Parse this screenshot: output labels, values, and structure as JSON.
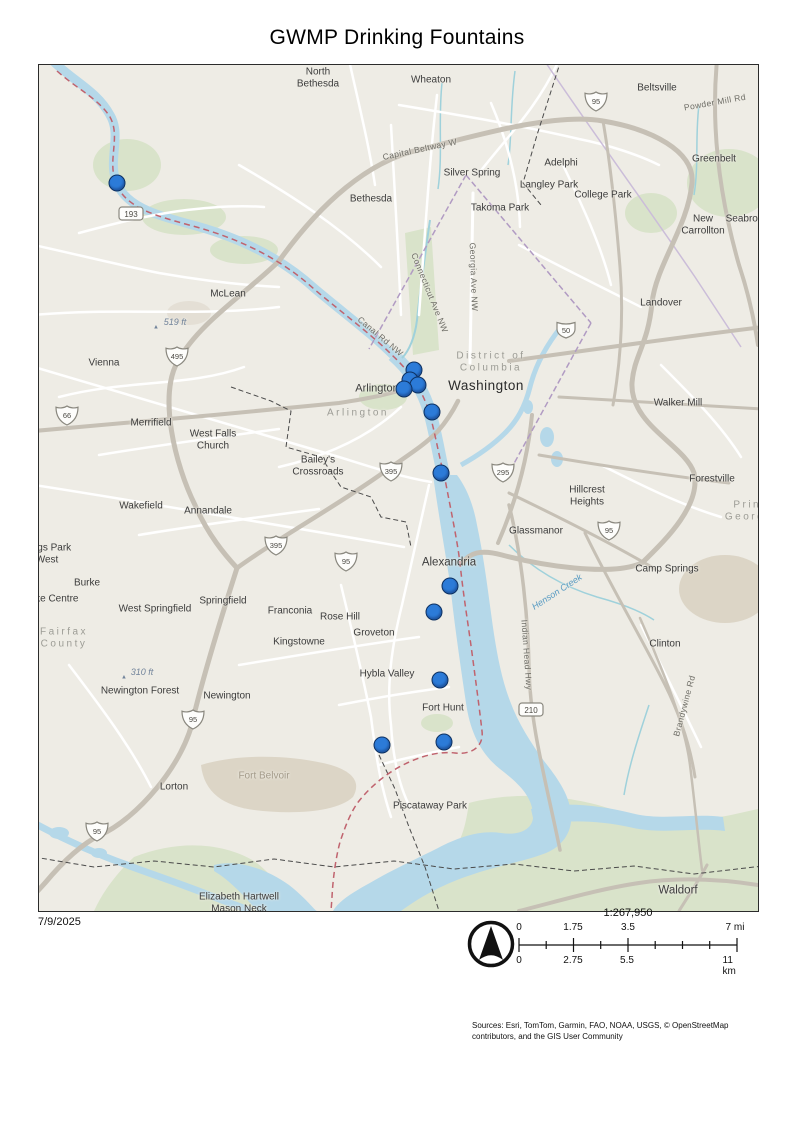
{
  "title": "GWMP Drinking Fountains",
  "footer": {
    "date": "7/9/2025",
    "scale_ratio": "1:267,950",
    "scale_mi": [
      "0",
      "1.75",
      "3.5",
      "7 mi"
    ],
    "scale_km": [
      "0",
      "2.75",
      "5.5",
      "11 km"
    ],
    "sources": "Sources: Esri, TomTom, Garmin, FAO, NOAA, USGS, © OpenStreetMap contributors, and the GIS User Community"
  },
  "colors": {
    "marker_fill": "#2c7bd8",
    "marker_stroke": "#0d3060",
    "land": "#eeece5",
    "water": "#b5d8e9",
    "park_green": "#d9e3ca",
    "trail_red": "#c0636e",
    "dc_boundary": "#b19bc3"
  },
  "map": {
    "labels": [
      {
        "t": "North Bethesda",
        "x": 279,
        "y": 13,
        "w": 64
      },
      {
        "t": "Wheaton",
        "x": 392,
        "y": 15
      },
      {
        "t": "Beltsville",
        "x": 618,
        "y": 23
      },
      {
        "t": "Powder Mill Rd",
        "x": 676,
        "y": 38,
        "c": "road",
        "r": -10
      },
      {
        "t": "Greenbelt",
        "x": 675,
        "y": 94
      },
      {
        "t": "Silver Spring",
        "x": 433,
        "y": 108
      },
      {
        "t": "Adelphi",
        "x": 522,
        "y": 98
      },
      {
        "t": "Langley Park",
        "x": 510,
        "y": 120
      },
      {
        "t": "College Park",
        "x": 564,
        "y": 130
      },
      {
        "t": "Takoma Park",
        "x": 461,
        "y": 143
      },
      {
        "t": "New Carrollton",
        "x": 664,
        "y": 160,
        "w": 62
      },
      {
        "t": "Seabrook",
        "x": 708,
        "y": 154
      },
      {
        "t": "Bethesda",
        "x": 332,
        "y": 134
      },
      {
        "t": "Capital Beltway W",
        "x": 381,
        "y": 85,
        "c": "road",
        "r": -12
      },
      {
        "t": "Connecticut Ave NW",
        "x": 390,
        "y": 228,
        "c": "road",
        "r": 68
      },
      {
        "t": "Georgia Ave NW",
        "x": 434,
        "y": 212,
        "c": "road",
        "r": 88
      },
      {
        "t": "Canal Rd NW",
        "x": 341,
        "y": 272,
        "c": "road",
        "r": 40
      },
      {
        "t": "McLean",
        "x": 189,
        "y": 229
      },
      {
        "t": "519 ft",
        "x": 136,
        "y": 257,
        "c": "elev"
      },
      {
        "t": "▲",
        "x": 117,
        "y": 263,
        "c": "elevmark"
      },
      {
        "t": "Vienna",
        "x": 65,
        "y": 298
      },
      {
        "t": "District of Columbia",
        "x": 452,
        "y": 297,
        "c": "gray",
        "w": 120
      },
      {
        "t": "Washington",
        "x": 447,
        "y": 321,
        "c": "place-lg"
      },
      {
        "t": "Arlington",
        "x": 338,
        "y": 324,
        "c": "place-md2"
      },
      {
        "t": "Arlington",
        "x": 319,
        "y": 348,
        "c": "gray"
      },
      {
        "t": "Merrifield",
        "x": 112,
        "y": 358
      },
      {
        "t": "West Falls Church",
        "x": 174,
        "y": 375,
        "w": 72
      },
      {
        "t": "Bailey's Crossroads",
        "x": 279,
        "y": 401,
        "w": 84
      },
      {
        "t": "Landover",
        "x": 622,
        "y": 238
      },
      {
        "t": "Walker Mill",
        "x": 639,
        "y": 338
      },
      {
        "t": "Forestville",
        "x": 673,
        "y": 414
      },
      {
        "t": "Hillcrest Heights",
        "x": 548,
        "y": 431,
        "w": 62
      },
      {
        "t": "Glassmanor",
        "x": 497,
        "y": 466
      },
      {
        "t": "Wakefield",
        "x": 102,
        "y": 441
      },
      {
        "t": "Annandale",
        "x": 169,
        "y": 446
      },
      {
        "t": "Kings Park West",
        "x": 8,
        "y": 489,
        "w": 66
      },
      {
        "t": "Burke",
        "x": 48,
        "y": 518
      },
      {
        "t": "Burke Centre",
        "x": 10,
        "y": 534
      },
      {
        "t": "Fairfax County",
        "x": 25,
        "y": 573,
        "c": "gray",
        "w": 70
      },
      {
        "t": "West Springfield",
        "x": 116,
        "y": 544,
        "w": 78
      },
      {
        "t": "Springfield",
        "x": 184,
        "y": 536
      },
      {
        "t": "Franconia",
        "x": 251,
        "y": 546
      },
      {
        "t": "Rose Hill",
        "x": 301,
        "y": 552
      },
      {
        "t": "Kingstowne",
        "x": 260,
        "y": 577
      },
      {
        "t": "Groveton",
        "x": 335,
        "y": 568
      },
      {
        "t": "Alexandria",
        "x": 410,
        "y": 498,
        "c": "place-md"
      },
      {
        "t": "Henson Creek",
        "x": 518,
        "y": 527,
        "c": "water",
        "r": -33
      },
      {
        "t": "Camp Springs",
        "x": 628,
        "y": 504
      },
      {
        "t": "Clinton",
        "x": 626,
        "y": 579
      },
      {
        "t": "Indian Head Hwy",
        "x": 487,
        "y": 590,
        "c": "road",
        "r": 86
      },
      {
        "t": "Brandywine Rd",
        "x": 646,
        "y": 641,
        "c": "road",
        "r": -75
      },
      {
        "t": "Hybla Valley",
        "x": 348,
        "y": 609
      },
      {
        "t": "Fort Hunt",
        "x": 404,
        "y": 643
      },
      {
        "t": "310 ft",
        "x": 103,
        "y": 607,
        "c": "elev"
      },
      {
        "t": "▲",
        "x": 85,
        "y": 613,
        "c": "elevmark"
      },
      {
        "t": "Newington Forest",
        "x": 101,
        "y": 626,
        "w": 80
      },
      {
        "t": "Newington",
        "x": 188,
        "y": 631
      },
      {
        "t": "Lorton",
        "x": 135,
        "y": 722
      },
      {
        "t": "Fort Belvoir",
        "x": 225,
        "y": 711,
        "c": "military"
      },
      {
        "t": "Piscataway Park",
        "x": 391,
        "y": 741
      },
      {
        "t": "Elizabeth Hartwell Mason Neck",
        "x": 200,
        "y": 838,
        "w": 92
      },
      {
        "t": "Waldorf",
        "x": 639,
        "y": 826,
        "c": "place-md"
      },
      {
        "t": "Prince George's",
        "x": 716,
        "y": 446,
        "c": "gray",
        "w": 66
      }
    ],
    "shields": [
      {
        "type": "interstate",
        "num": "95",
        "x": 557,
        "y": 39
      },
      {
        "type": "interstate",
        "num": "495",
        "x": 138,
        "y": 294
      },
      {
        "type": "interstate",
        "num": "66",
        "x": 28,
        "y": 353
      },
      {
        "type": "interstate",
        "num": "395",
        "x": 352,
        "y": 409
      },
      {
        "type": "interstate",
        "num": "395",
        "x": 237,
        "y": 483
      },
      {
        "type": "interstate",
        "num": "95",
        "x": 307,
        "y": 499
      },
      {
        "type": "interstate",
        "num": "295",
        "x": 464,
        "y": 410
      },
      {
        "type": "interstate",
        "num": "95",
        "x": 570,
        "y": 468
      },
      {
        "type": "interstate",
        "num": "95",
        "x": 154,
        "y": 657
      },
      {
        "type": "interstate",
        "num": "95",
        "x": 58,
        "y": 769
      },
      {
        "type": "us",
        "num": "50",
        "x": 527,
        "y": 268
      },
      {
        "type": "state",
        "num": "193",
        "x": 92,
        "y": 151
      },
      {
        "type": "state",
        "num": "210",
        "x": 492,
        "y": 647
      }
    ],
    "fountains": {
      "layer_name": "GWMP Drinking Fountains",
      "points": [
        {
          "x": 78,
          "y": 118
        },
        {
          "x": 375,
          "y": 305
        },
        {
          "x": 371,
          "y": 315
        },
        {
          "x": 379,
          "y": 320
        },
        {
          "x": 365,
          "y": 324
        },
        {
          "x": 393,
          "y": 347
        },
        {
          "x": 402,
          "y": 408
        },
        {
          "x": 411,
          "y": 521
        },
        {
          "x": 395,
          "y": 547
        },
        {
          "x": 401,
          "y": 615
        },
        {
          "x": 405,
          "y": 677
        },
        {
          "x": 343,
          "y": 680
        }
      ]
    }
  }
}
